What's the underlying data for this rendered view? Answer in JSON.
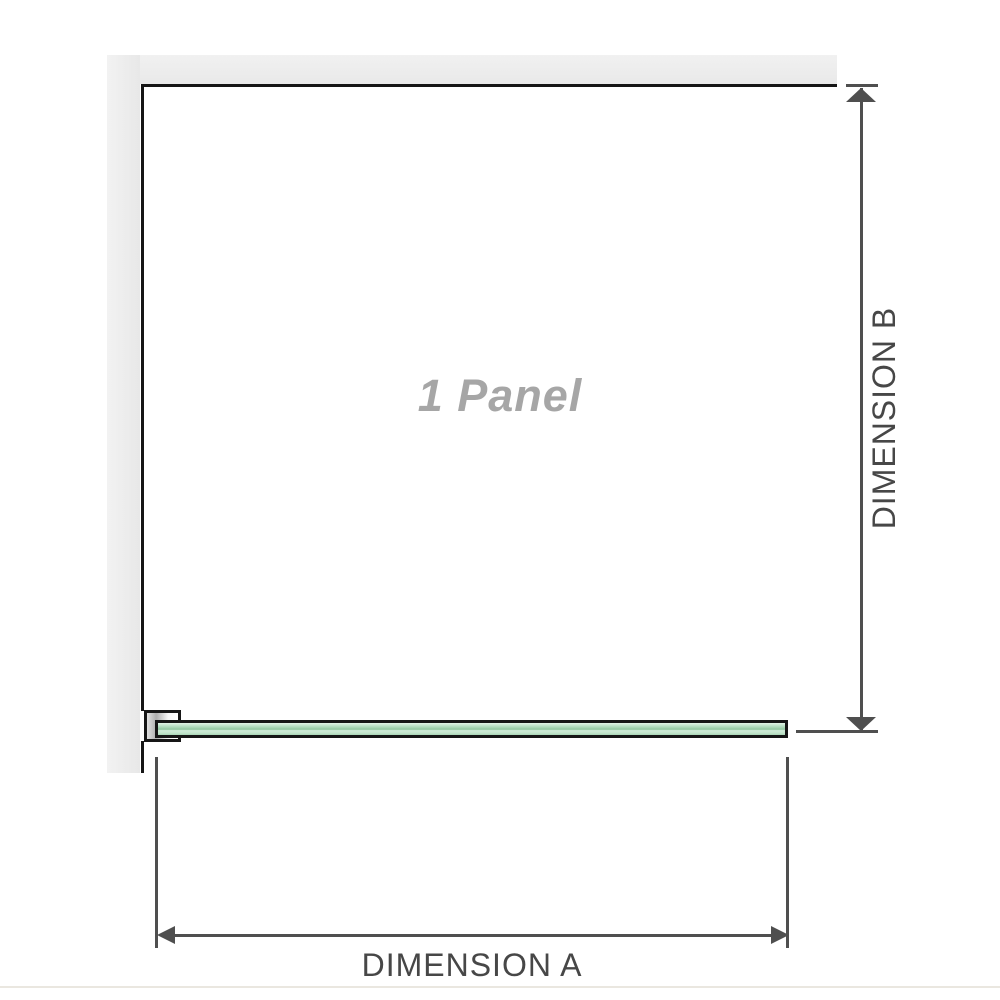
{
  "diagram": {
    "panel_label": "1 Panel",
    "dimension_a": {
      "label": "DIMENSION A"
    },
    "dimension_b": {
      "label": "DIMENSION B"
    }
  },
  "colors": {
    "background": "#ffffff",
    "wall_gray": "#ebebeb",
    "outline_black": "#161616",
    "dimension_line_gray": "#4f4f4f",
    "dimension_label_gray": "#474747",
    "panel_label_gray": "#a6a6a6",
    "glass_green_light": "#d8efe0",
    "glass_green_mid": "#8fc49e",
    "footer_line": "#eae7e0"
  }
}
